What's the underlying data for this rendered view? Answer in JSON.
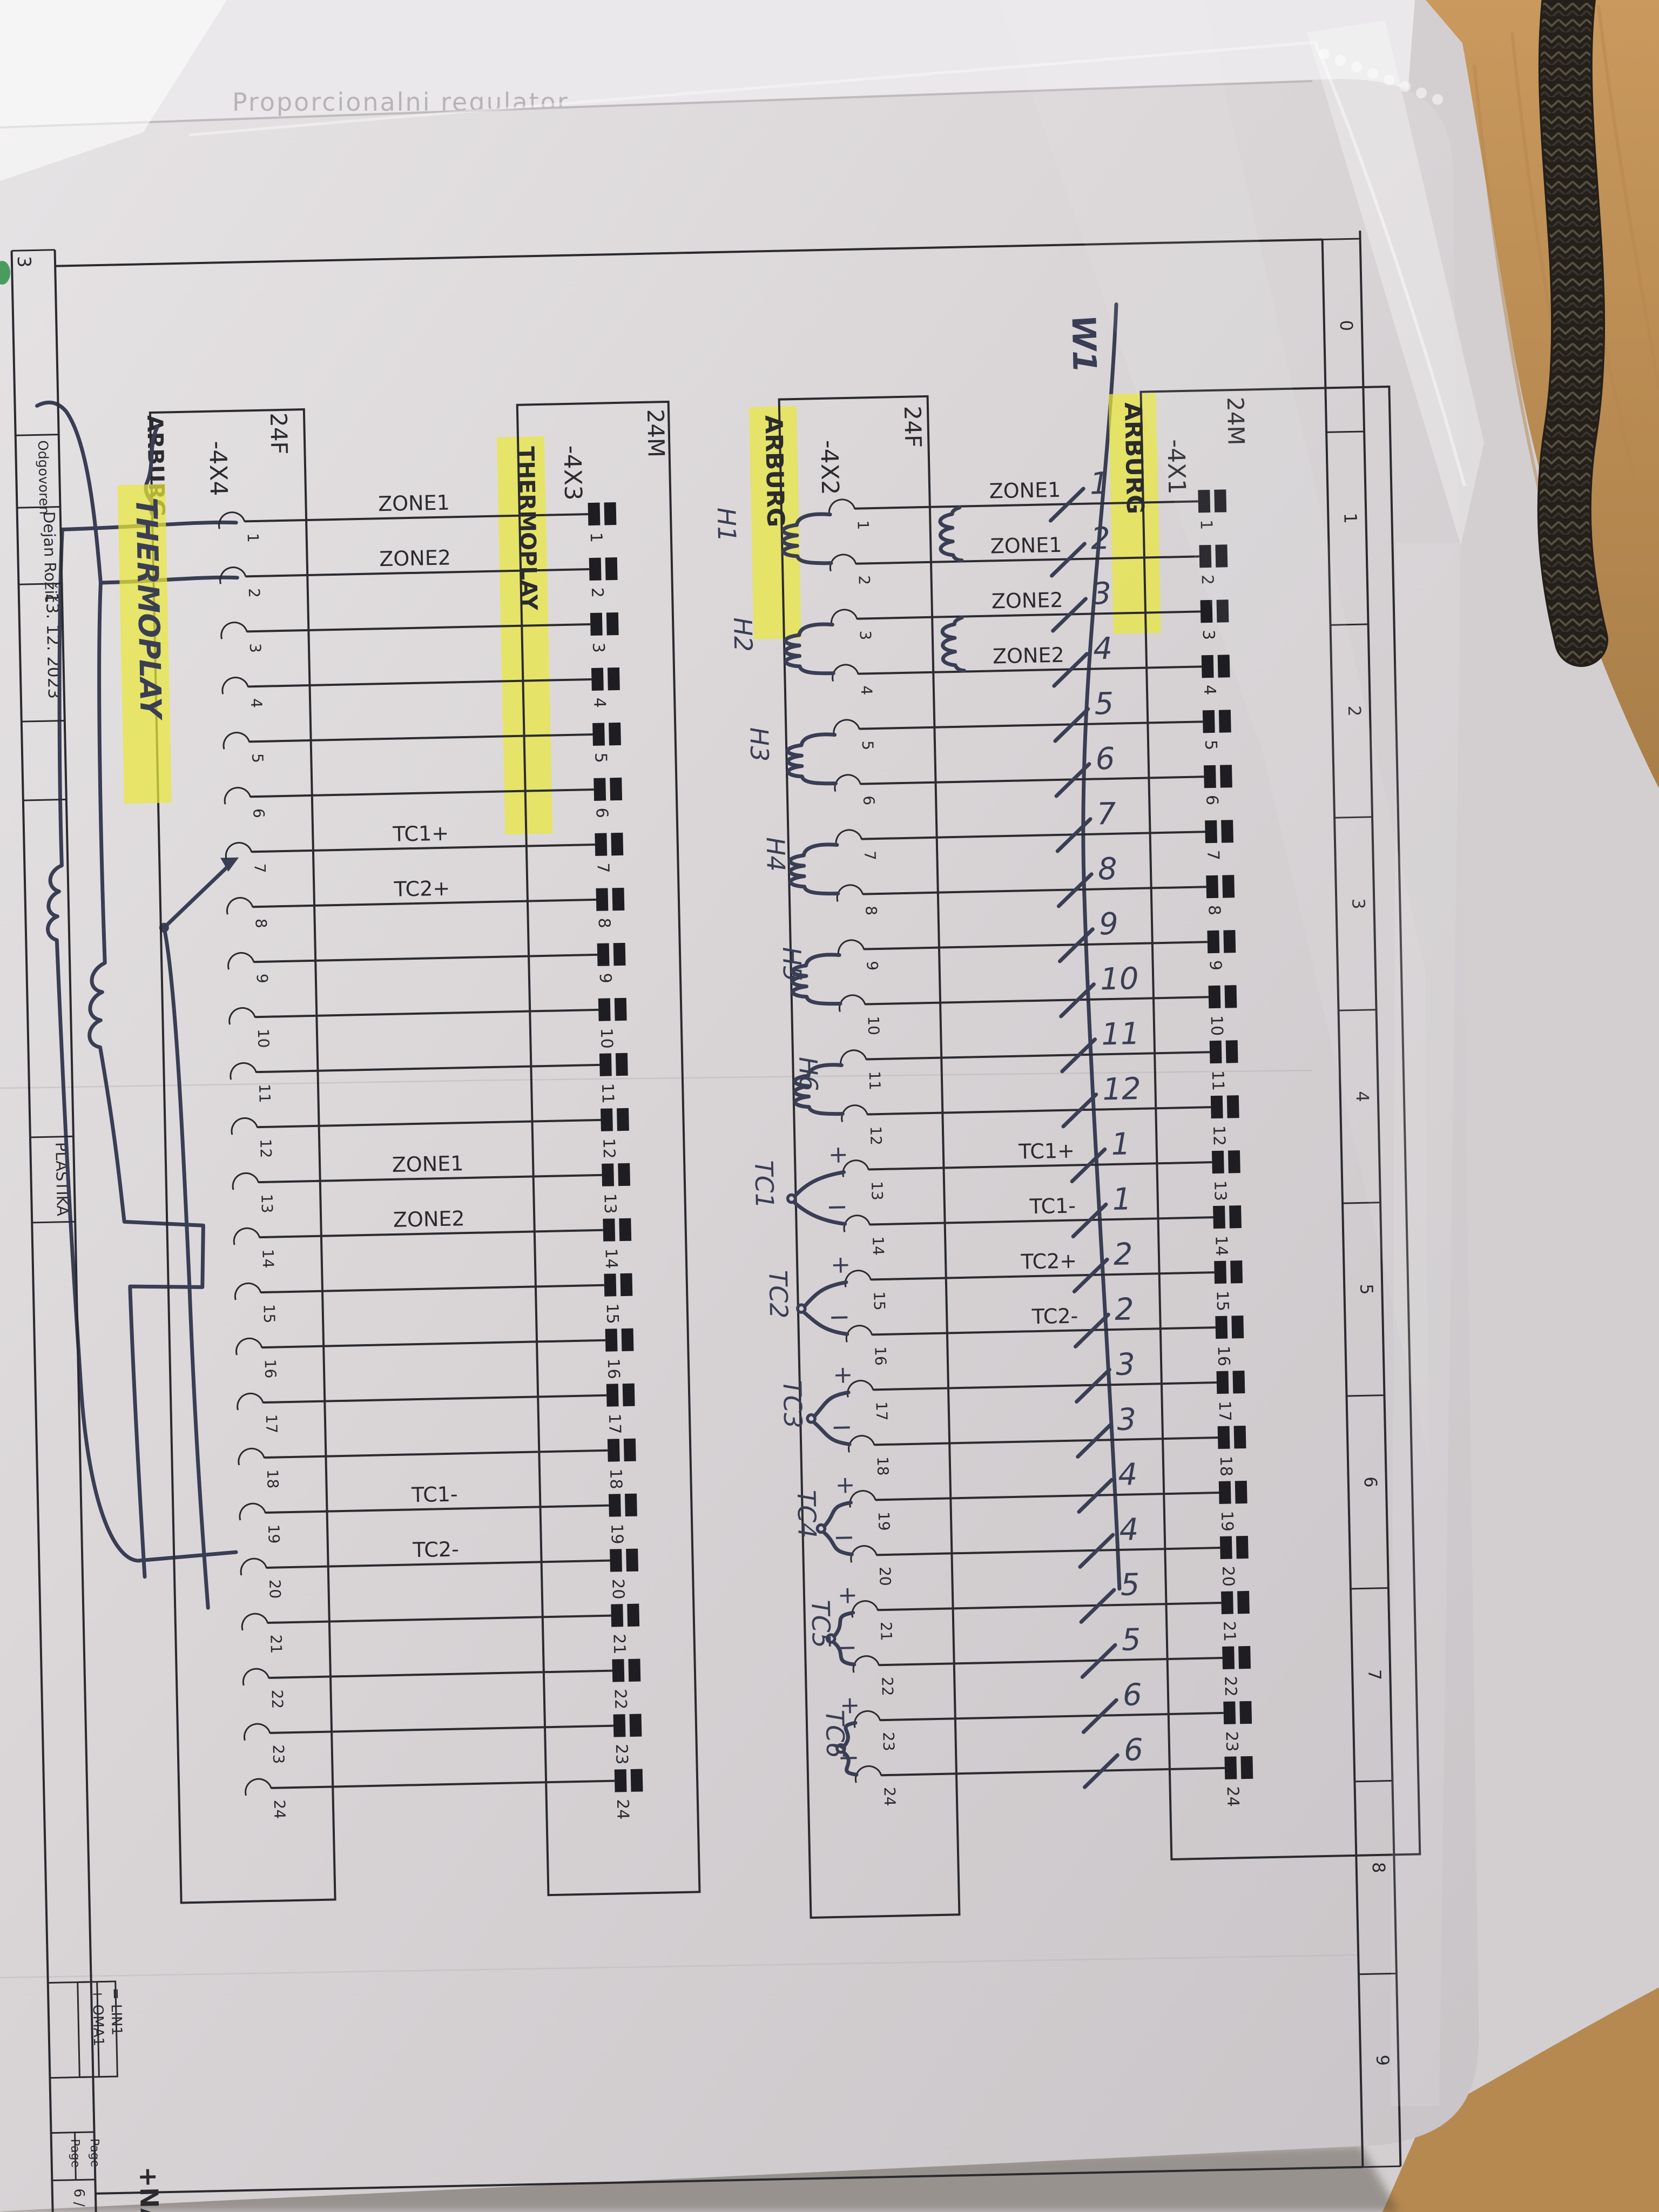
{
  "scene": {
    "background_sheet_text": "Proporcionalni regulator",
    "paper_color": "#d9d5d7",
    "highlight_color": "#e9e73c",
    "pen_color": "#3a3e54",
    "ink_color": "#2a2a2f",
    "desk_color": "#c09157",
    "cable_color": "#241f1a"
  },
  "title_block": {
    "corner_number": "3",
    "responsible_label": "Odgovoren",
    "responsible_name": "Dejan Rožič",
    "date": "13. 12. 2023",
    "customer": "PLASTIKA",
    "location_ref": "= LIN1",
    "plant_ref": "+ OMA1",
    "page_label_1": "Page",
    "page_label_2": "Page",
    "page_number": "6 / 8",
    "next_ref": "+NAC/4"
  },
  "frame": {
    "column_numbers": [
      "0",
      "1",
      "2",
      "3",
      "4",
      "5",
      "6",
      "7",
      "8",
      "9"
    ]
  },
  "pin_numbers": [
    "1",
    "2",
    "3",
    "4",
    "5",
    "6",
    "7",
    "8",
    "9",
    "10",
    "11",
    "12",
    "13",
    "14",
    "15",
    "16",
    "17",
    "18",
    "19",
    "20",
    "21",
    "22",
    "23",
    "24"
  ],
  "connectors": [
    {
      "designator": "-4X4",
      "gender_label": "24F",
      "company": "ARBURG",
      "pin_type": "female",
      "company_struck": true,
      "handwritten_company_highlighted": true
    },
    {
      "designator": "-4X3",
      "gender_label": "24M",
      "company": "THERMOPLAY",
      "pin_type": "male",
      "company_highlighted": true,
      "wire_labels": [
        {
          "pin": 1,
          "label": "ZONE1"
        },
        {
          "pin": 2,
          "label": "ZONE2"
        },
        {
          "pin": 7,
          "label": "TC1+"
        },
        {
          "pin": 8,
          "label": "TC2+"
        },
        {
          "pin": 13,
          "label": "ZONE1"
        },
        {
          "pin": 14,
          "label": "ZONE2"
        },
        {
          "pin": 19,
          "label": "TC1-"
        },
        {
          "pin": 20,
          "label": "TC2-"
        }
      ]
    },
    {
      "designator": "-4X2",
      "gender_label": "24F",
      "company": "ARBURG",
      "pin_type": "female",
      "company_highlighted": true
    },
    {
      "designator": "-4X1",
      "gender_label": "24M",
      "company": "ARBURG",
      "pin_type": "male",
      "company_highlighted": true,
      "wire_labels": [
        {
          "pin": 1,
          "label": "ZONE1"
        },
        {
          "pin": 2,
          "label": "ZONE1"
        },
        {
          "pin": 3,
          "label": "ZONE2"
        },
        {
          "pin": 4,
          "label": "ZONE2"
        },
        {
          "pin": 13,
          "label": "TC1+"
        },
        {
          "pin": 14,
          "label": "TC1-"
        },
        {
          "pin": 15,
          "label": "TC2+"
        },
        {
          "pin": 16,
          "label": "TC2-"
        }
      ]
    }
  ],
  "handwriting": {
    "cable_tag": "W1",
    "replacement_company": "THERMOPLAY",
    "wire_numbers_upper": [
      "1",
      "2",
      "3",
      "4",
      "5",
      "6",
      "7",
      "8",
      "9",
      "10",
      "11",
      "12"
    ],
    "wire_numbers_lower": [
      "1",
      "1",
      "2",
      "2",
      "3",
      "3",
      "4",
      "4",
      "5",
      "5",
      "6",
      "6"
    ],
    "heater_tags": [
      "H1",
      "H2",
      "H3",
      "H4",
      "H5",
      "H6"
    ],
    "thermocouple_tags": [
      "TC1",
      "TC2",
      "TC3",
      "TC4",
      "TC5",
      "TC6"
    ],
    "tc_plus_sign": "+",
    "tc_minus_sign": "−"
  }
}
